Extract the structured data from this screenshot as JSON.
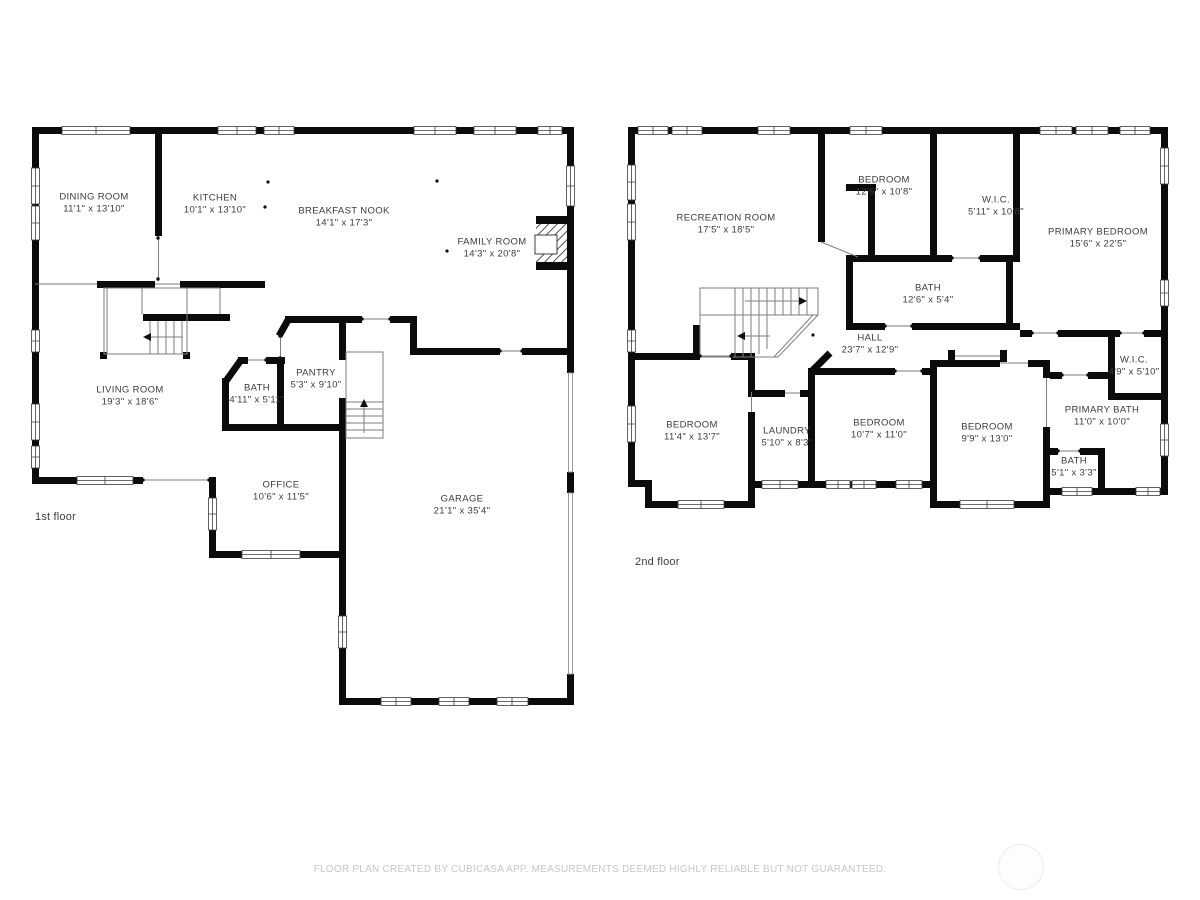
{
  "floors": [
    {
      "label": "1st floor",
      "rooms": [
        {
          "name": "DINING ROOM",
          "dims": "11'1\" x 13'10\""
        },
        {
          "name": "KITCHEN",
          "dims": "10'1\" x 13'10\""
        },
        {
          "name": "BREAKFAST NOOK",
          "dims": "14'1\" x 17'3\""
        },
        {
          "name": "FAMILY ROOM",
          "dims": "14'3\" x 20'8\""
        },
        {
          "name": "LIVING ROOM",
          "dims": "19'3\" x 18'6\""
        },
        {
          "name": "BATH",
          "dims": "4'11\" x 5'11\""
        },
        {
          "name": "PANTRY",
          "dims": "5'3\" x 9'10\""
        },
        {
          "name": "OFFICE",
          "dims": "10'6\" x 11'5\""
        },
        {
          "name": "GARAGE",
          "dims": "21'1\" x 35'4\""
        }
      ]
    },
    {
      "label": "2nd floor",
      "rooms": [
        {
          "name": "RECREATION ROOM",
          "dims": "17'5\" x 18'5\""
        },
        {
          "name": "BEDROOM",
          "dims": "12'6\" x 10'8\""
        },
        {
          "name": "W.I.C.",
          "dims": "5'11\" x 10'8\""
        },
        {
          "name": "PRIMARY BEDROOM",
          "dims": "15'6\" x 22'5\""
        },
        {
          "name": "BATH",
          "dims": "12'6\" x 5'4\""
        },
        {
          "name": "HALL",
          "dims": "23'7\" x 12'9\""
        },
        {
          "name": "W.I.C.",
          "dims": "4'9\" x 5'10\""
        },
        {
          "name": "BEDROOM",
          "dims": "11'4\" x 13'7\""
        },
        {
          "name": "LAUNDRY",
          "dims": "5'10\" x 8'3\""
        },
        {
          "name": "BEDROOM",
          "dims": "10'7\" x 11'0\""
        },
        {
          "name": "BEDROOM",
          "dims": "9'9\" x 13'0\""
        },
        {
          "name": "PRIMARY BATH",
          "dims": "11'0\" x 10'0\""
        },
        {
          "name": "BATH",
          "dims": "5'1\" x 3'3\""
        }
      ]
    }
  ],
  "footer": {
    "disclaimer": "FLOOR PLAN CREATED BY CUBICASA APP. MEASUREMENTS DEEMED HIGHLY RELIABLE BUT NOT GUARANTEED."
  },
  "colors": {
    "wall": "#0b0b0b",
    "background": "#ffffff",
    "label": "#3b3b3b",
    "muted": "#c7c7c7"
  }
}
